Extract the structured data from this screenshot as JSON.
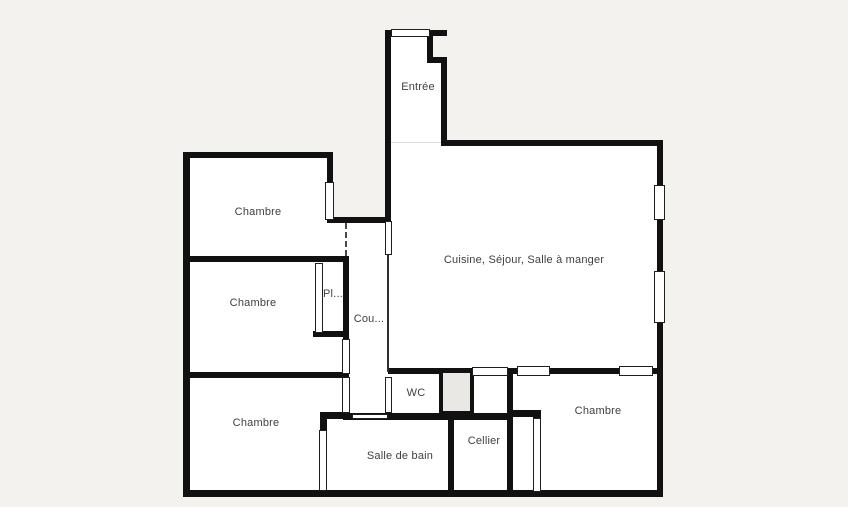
{
  "colors": {
    "background": "#f3f2ef",
    "wall": "#111111",
    "floor": "#ffffff",
    "shaft": "#eae8e4",
    "label": "#3f3f3f"
  },
  "rooms": {
    "entree": {
      "label": "Entrée"
    },
    "chambre_top_left": {
      "label": "Chambre"
    },
    "chambre_mid_left": {
      "label": "Chambre"
    },
    "chambre_bottom_left": {
      "label": "Chambre"
    },
    "chambre_bottom_right": {
      "label": "Chambre"
    },
    "placard": {
      "label": "Pl..."
    },
    "couloir": {
      "label": "Cou..."
    },
    "living": {
      "label": "Cuisine, Séjour, Salle à manger"
    },
    "wc": {
      "label": "WC"
    },
    "salle_de_bain": {
      "label": "Salle de bain"
    },
    "cellier": {
      "label": "Cellier"
    }
  }
}
